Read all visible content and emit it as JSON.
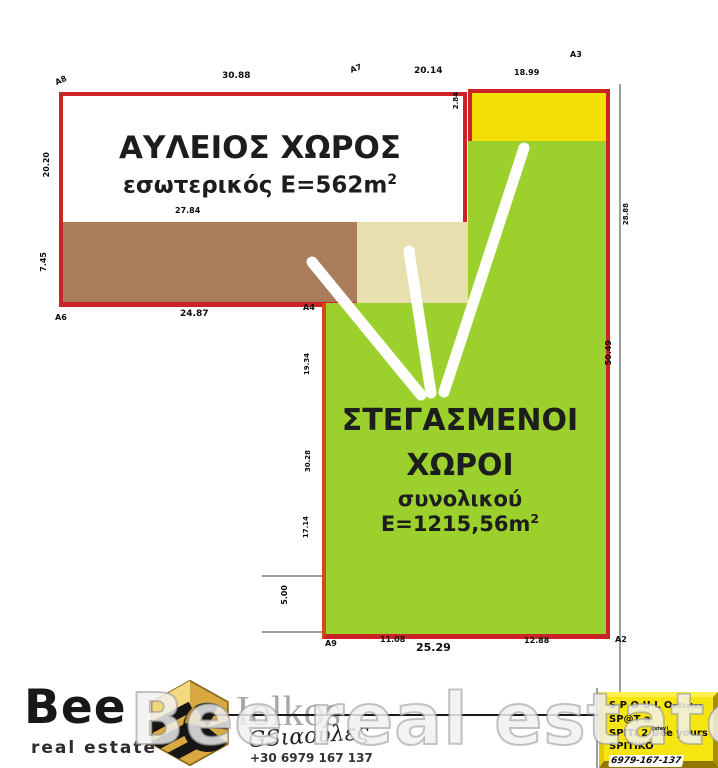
{
  "plan": {
    "courtyard": {
      "title": "ΑΥΛΕΙΟΣ ΧΩΡΟΣ",
      "area_text": "εσωτερικός E=562m",
      "area_sup": "2"
    },
    "covered": {
      "title_line1": "ΣΤΕΓΑΣΜΕΝΟΙ",
      "title_line2": "ΧΩΡΟΙ",
      "area_text": "συνολικού E=1215,56m",
      "area_sup": "2"
    },
    "measurements": {
      "a8": "A8",
      "top1": "30.88",
      "a7": "A7",
      "top2": "20.14",
      "top3": "18.99",
      "a3": "A3",
      "left1": "20.20",
      "left2": "7.45",
      "a6": "A6",
      "courtyard_bottom": "27.84",
      "brown_bottom": "24.87",
      "a4": "A4",
      "yellow_left": "2.84",
      "right1": "28.88",
      "right2": "50.49",
      "green_left1": "19.34",
      "green_left2": "30.28",
      "green_left3": "17.14",
      "notch": "5.00",
      "a9": "A9",
      "bottom1": "11.08",
      "bottom2": "25.29",
      "bottom3": "12.88",
      "a2": "A2"
    }
  },
  "footer": {
    "brand": "Bee",
    "brand_sub": "real estate",
    "partner": "Iolkos",
    "signature": "GSιαούλες",
    "phone": "+30 6979 167 137",
    "watermark": "Bee real estate"
  },
  "promo": {
    "line1a": "S P O U L O",
    "line1b": "eStates",
    "line2": "SP@T  a",
    "line3": "SPITI 2 Bee yours",
    "line3_note": "(stay)",
    "line4_label": "SPITIKO",
    "line4_phone": "6979-167-137"
  },
  "colors": {
    "boundary_red": "#cc2328",
    "plot_green": "#9cd02c",
    "plot_yellow": "#f2df06",
    "plot_brown": "#ab7c5c",
    "plot_beige": "#e8dfae",
    "promo_yellow": "#f7e512"
  }
}
